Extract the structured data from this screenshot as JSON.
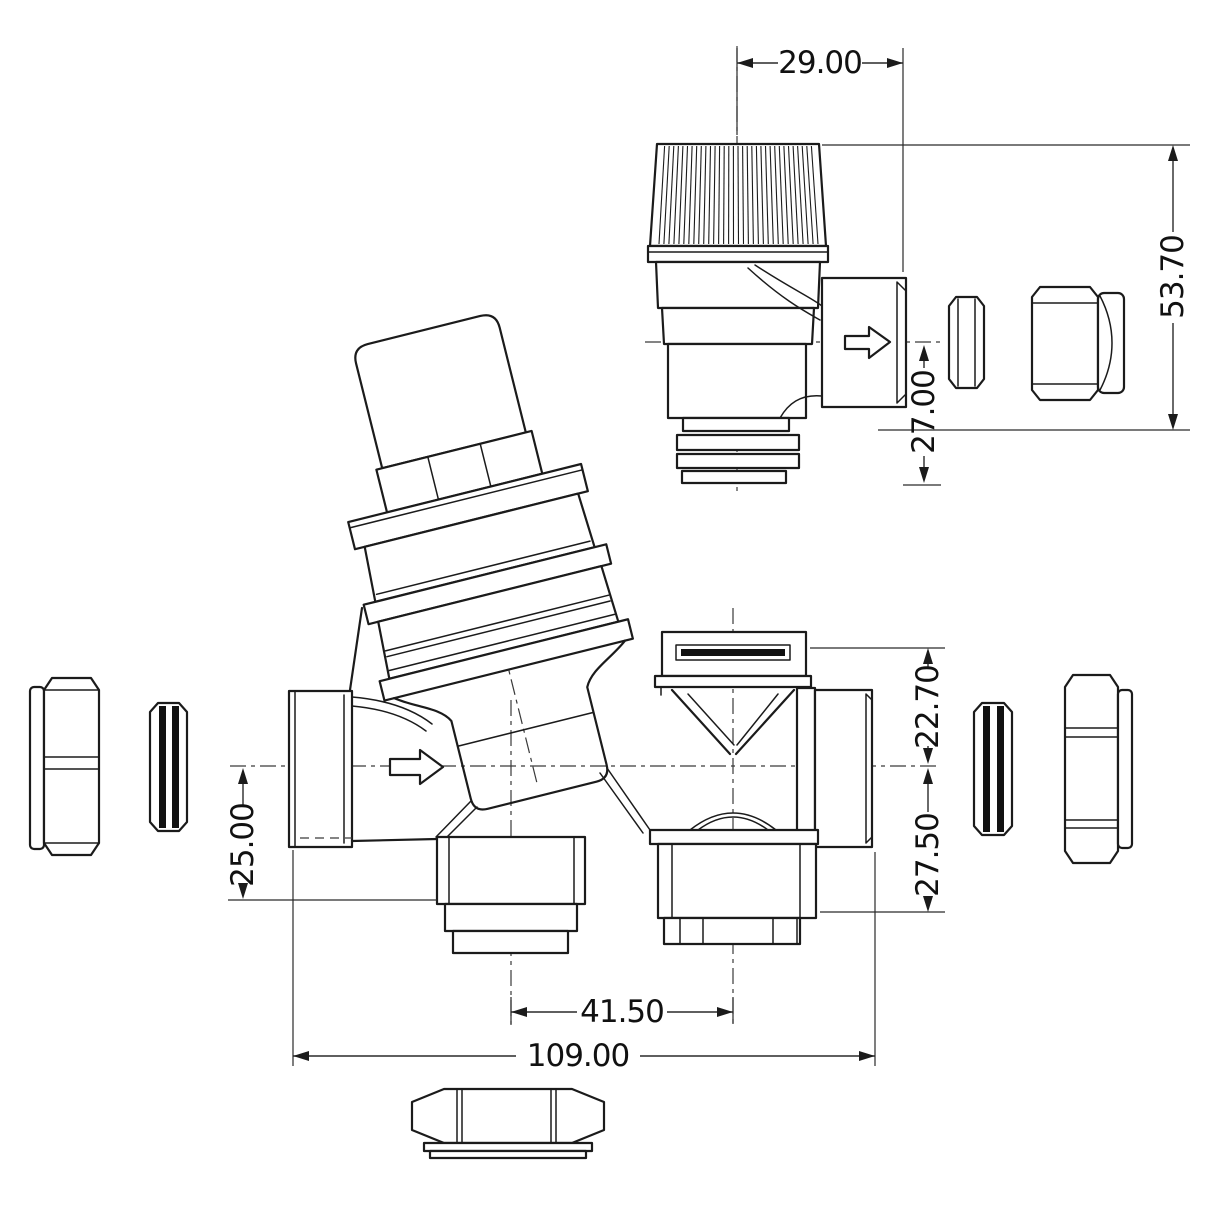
{
  "drawing": {
    "type": "engineering-dimension-drawing",
    "background": "#ffffff",
    "stroke_color": "#1b1b1b",
    "views": {
      "relief_valve": "pressure-relief-valve-side-view",
      "main_valve": "pressure-reducing-valve-front-view",
      "fittings": [
        "compression-nut-left",
        "olive-left",
        "olive-right",
        "compression-nut-right",
        "olive-top",
        "compression-nut-top",
        "compression-nut-front-view"
      ]
    },
    "icons": {
      "flow_arrow": "flow-direction-arrow"
    },
    "dimensions": {
      "relief_cap_width": "29.00",
      "relief_overall_height": "53.70",
      "relief_outlet_to_tail": "27.00",
      "outlet_above_centerline": "22.70",
      "outlet_below_centerline": "27.50",
      "centerline_to_drain": "25.00",
      "drain_port_spacing": "41.50",
      "overall_length": "109.00"
    }
  }
}
